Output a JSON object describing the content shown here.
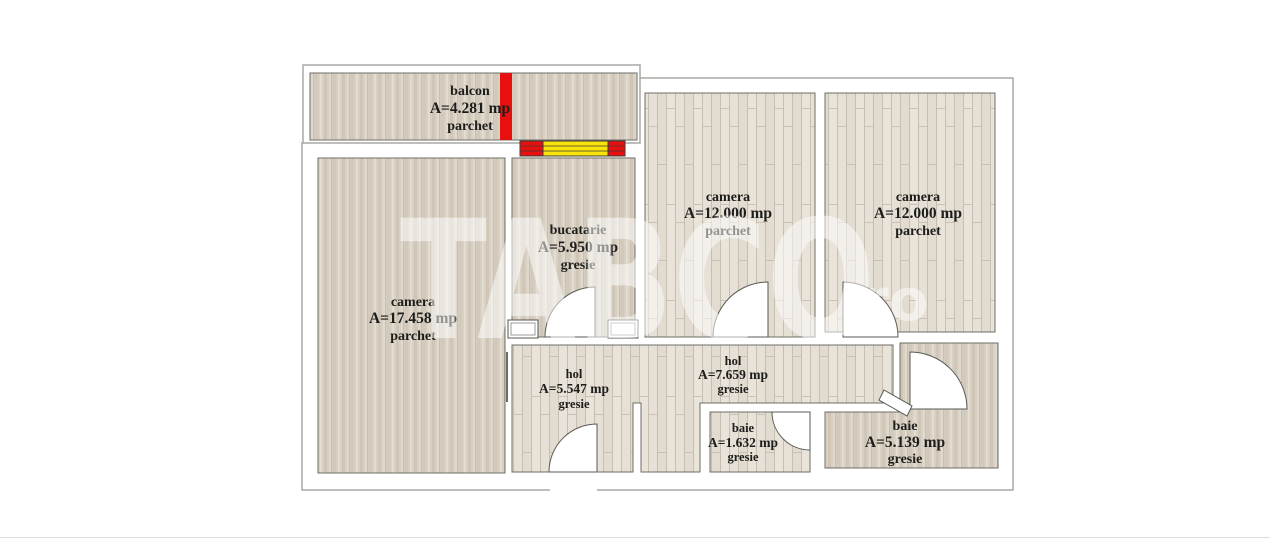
{
  "watermark": {
    "text": "TABCO",
    "suffix": ".ro"
  },
  "rooms": [
    {
      "id": "balcon",
      "name": "balcon",
      "area": "A=4.281 mp",
      "floor": "parchet"
    },
    {
      "id": "camera-mare",
      "name": "camera",
      "area": "A=17.458 mp",
      "floor": "parchet"
    },
    {
      "id": "bucatarie",
      "name": "bucatarie",
      "area": "A=5.950 mp",
      "floor": "gresie"
    },
    {
      "id": "camera-1",
      "name": "camera",
      "area": "A=12.000 mp",
      "floor": "parchet"
    },
    {
      "id": "camera-2",
      "name": "camera",
      "area": "A=12.000 mp",
      "floor": "parchet"
    },
    {
      "id": "hol-1",
      "name": "hol",
      "area": "A=5.547 mp",
      "floor": "gresie"
    },
    {
      "id": "hol-2",
      "name": "hol",
      "area": "A=7.659 mp",
      "floor": "gresie"
    },
    {
      "id": "baie-mica",
      "name": "baie",
      "area": "A=1.632 mp",
      "floor": "gresie"
    },
    {
      "id": "baie-mare",
      "name": "baie",
      "area": "A=5.139 mp",
      "floor": "gresie"
    }
  ],
  "colors": {
    "window_red": "#e8100e",
    "window_yellow": "#f9e30d",
    "balcony_marker_red": "#e8100e",
    "stone_floor": "#d8d0c3",
    "plank_floor": "#e6e0d6",
    "wall_outline": "#a9a9a3",
    "room_border": "#6e6e66",
    "label_text": "#1d1d1b",
    "watermark_white": "#ffffff"
  }
}
